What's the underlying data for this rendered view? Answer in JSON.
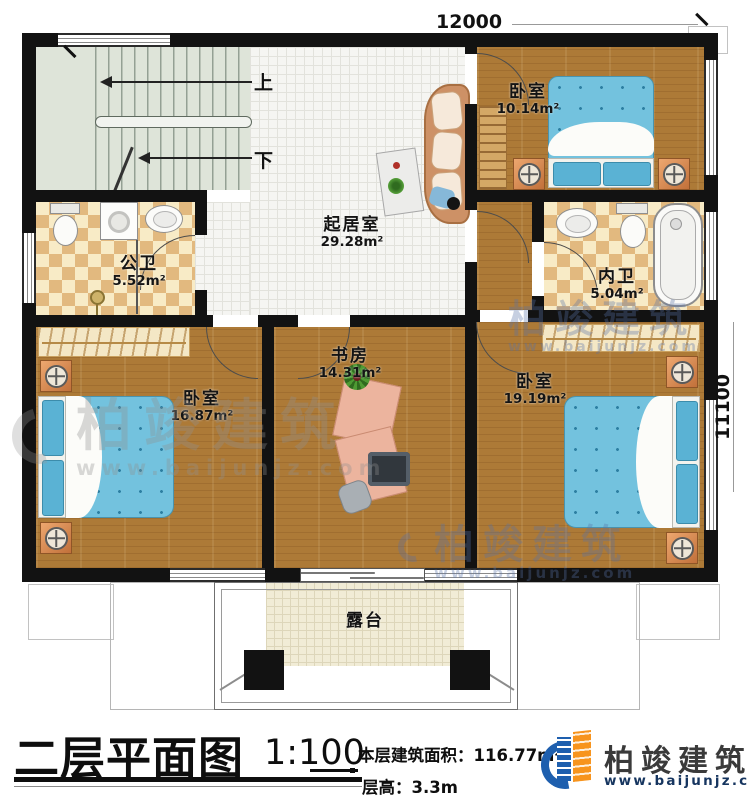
{
  "plan": {
    "dimensions": {
      "top": "12000",
      "right": "11100"
    },
    "stairs": {
      "up": "上",
      "down": "下"
    },
    "rooms": [
      {
        "name": "卧室",
        "area": "10.14m²"
      },
      {
        "name": "起居室",
        "area": "29.28m²"
      },
      {
        "name": "公卫",
        "area": "5.52m²"
      },
      {
        "name": "内卫",
        "area": "5.04m²"
      },
      {
        "name": "书房",
        "area": "14.31m²"
      },
      {
        "name": "卧室",
        "area": "16.87m²"
      },
      {
        "name": "卧室",
        "area": "19.19m²"
      },
      {
        "name": "露台",
        "area": ""
      }
    ]
  },
  "watermark": {
    "text": "柏竣建筑",
    "url": "www.baijunjz.com"
  },
  "title_bar": {
    "plan_title": "二层平面图",
    "scale": "1:100",
    "area_text": "本层建筑面积：116.77m²",
    "height_text": "层高：3.3m"
  },
  "logo": {
    "name": "柏竣建筑",
    "url": "www.baijunjz.com"
  },
  "colors": {
    "wall": "#121212",
    "wood": "#ad7a37",
    "bed_blue": "#73c2de",
    "brand_blue": "#1e5fae",
    "brand_orange": "#f7941e"
  }
}
